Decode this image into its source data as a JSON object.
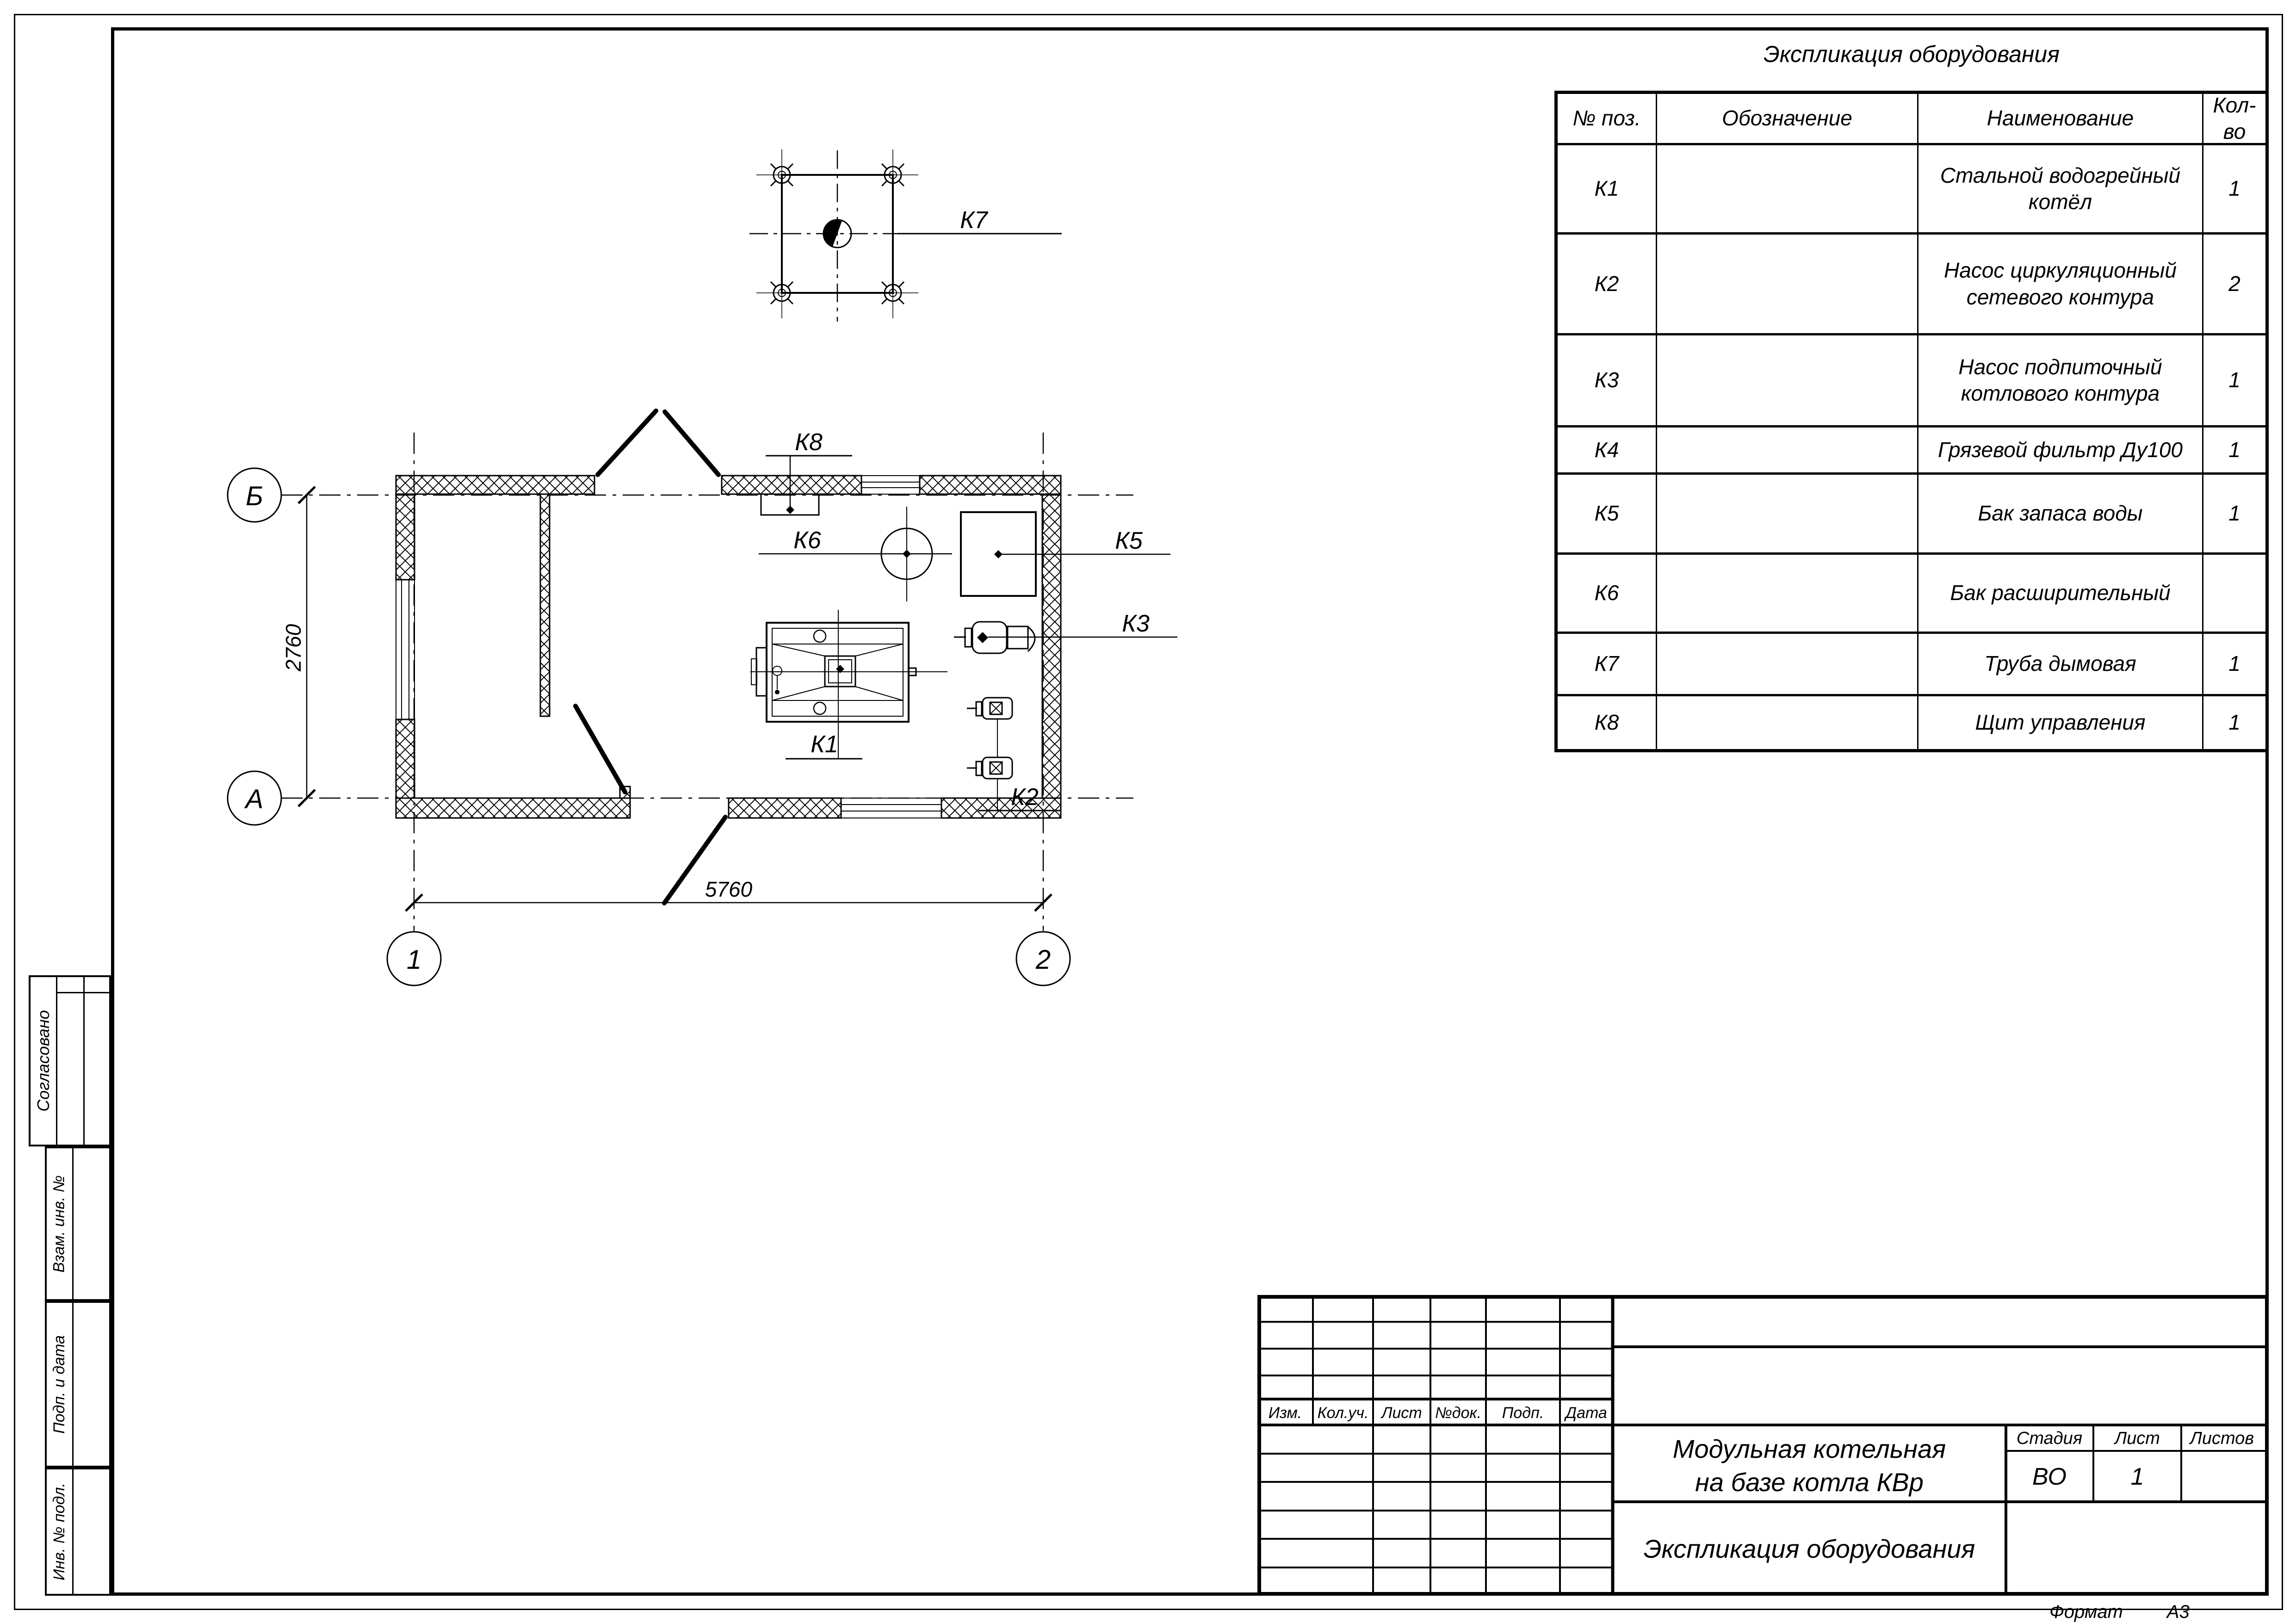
{
  "sheet": {
    "format_label": "Формат",
    "format_value": "А3"
  },
  "spec_table": {
    "title": "Экспликация оборудования",
    "headers": {
      "pos": "№ поз.",
      "designation": "Обозначение",
      "name": "Наименование",
      "qty": "Кол-во"
    },
    "rows": [
      {
        "pos": "К1",
        "designation": "",
        "name": "Стальной водогрейный котёл",
        "qty": "1"
      },
      {
        "pos": "К2",
        "designation": "",
        "name": "Насос циркуляционный сетевого контура",
        "qty": "2"
      },
      {
        "pos": "К3",
        "designation": "",
        "name": "Насос подпиточный котлового контура",
        "qty": "1"
      },
      {
        "pos": "К4",
        "designation": "",
        "name": "Грязевой фильтр Ду100",
        "qty": "1"
      },
      {
        "pos": "К5",
        "designation": "",
        "name": "Бак запаса воды",
        "qty": "1"
      },
      {
        "pos": "К6",
        "designation": "",
        "name": "Бак расширительный",
        "qty": ""
      },
      {
        "pos": "К7",
        "designation": "",
        "name": "Труба дымовая",
        "qty": "1"
      },
      {
        "pos": "К8",
        "designation": "",
        "name": "Щит управления",
        "qty": "1"
      }
    ]
  },
  "title_block": {
    "revision_columns": [
      "Изм.",
      "Кол.уч.",
      "Лист",
      "№док.",
      "Подп.",
      "Дата"
    ],
    "project_name_lines": [
      "Модульная котельная",
      "на базе котла КВр"
    ],
    "document_name": "Экспликация оборудования",
    "stage_label": "Стадия",
    "sheet_label": "Лист",
    "sheets_label": "Листов",
    "stage_value": "ВО",
    "sheet_value": "1",
    "sheets_value": ""
  },
  "sidebar": {
    "approved": "Согласовано",
    "replace_inv": "Взам. инв. №",
    "sign_date": "Подп. и дата",
    "inv_original": "Инв. № подл."
  },
  "plan": {
    "axis_horizontal_top": "Б",
    "axis_horizontal_bottom": "А",
    "axis_vertical_left": "1",
    "axis_vertical_right": "2",
    "dim_height": "2760",
    "dim_width": "5760",
    "labels": {
      "k1": "К1",
      "k2": "К2",
      "k3": "К3",
      "k5": "К5",
      "k6": "К6",
      "k7": "К7",
      "k8": "К8"
    }
  }
}
